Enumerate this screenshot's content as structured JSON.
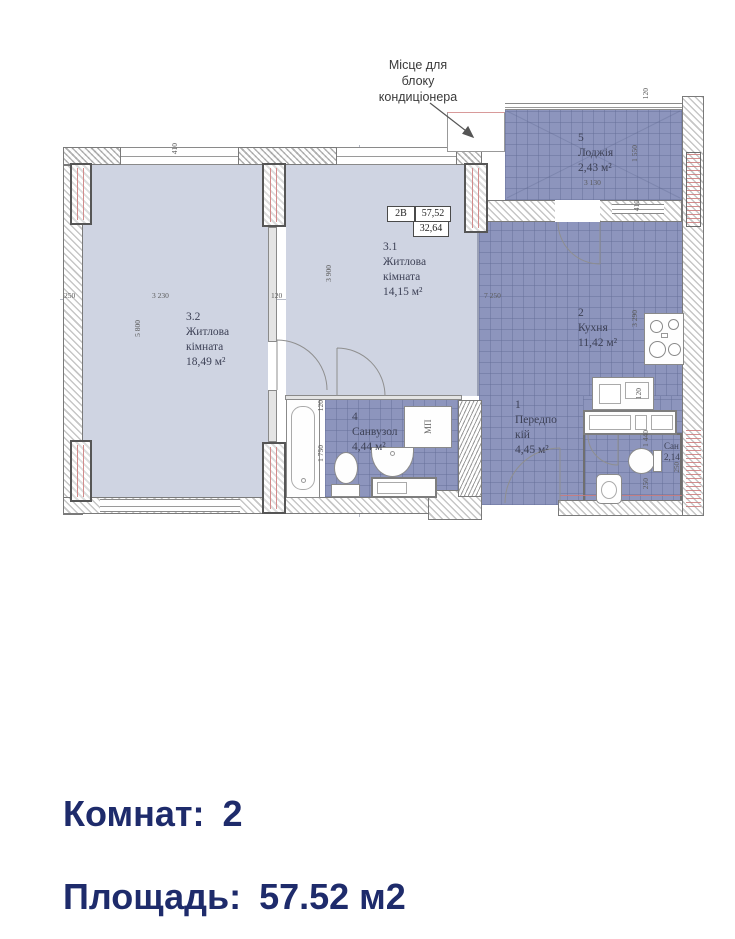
{
  "colors": {
    "room_light": "#cfd4e2",
    "room_dark_tile": "#8d95bd",
    "summary_navy": "#1e2b6b",
    "red_axis": "#d28b8b"
  },
  "ac_note": {
    "line1": "Місце для",
    "line2": "блоку",
    "line3": "кондиціонера"
  },
  "info_table": {
    "type": "2В",
    "total": "57,52",
    "living": "32,64"
  },
  "rooms": {
    "r32": {
      "num": "3.2",
      "name1": "Житлова",
      "name2": "кімната",
      "area": "18,49 м²"
    },
    "r31": {
      "num": "3.1",
      "name1": "Житлова",
      "name2": "кімната",
      "area": "14,15 м²"
    },
    "r5": {
      "num": "5",
      "name1": "Лоджія",
      "area": "2,43 м²"
    },
    "r2": {
      "num": "2",
      "name1": "Кухня",
      "area": "11,42 м²"
    },
    "r4": {
      "num": "4",
      "name1": "Санвузол",
      "area": "4,44 м²"
    },
    "r1": {
      "num": "1",
      "name1": "Передпо",
      "name2": "кій",
      "area": "4,45 м²"
    },
    "r3": {
      "name1": "Сан",
      "area": "2,14"
    }
  },
  "fixtures": {
    "washer_label": "МП"
  },
  "dims": {
    "w410a": "410",
    "w410b": "410",
    "d120a": "120",
    "d120b": "120",
    "d120c": "120",
    "d120d": "120",
    "d1550": "1 550",
    "d3130": "3 130",
    "d250a": "250",
    "d3230": "3 230",
    "d7250": "7 250",
    "d5800": "5 800",
    "d3900": "3 900",
    "d3290": "3 290",
    "d1750": "1 750",
    "d1440": "1 440",
    "d250b": "250",
    "d250c": "250"
  },
  "summary": {
    "rooms_label": "Комнат:",
    "rooms_value": "2",
    "area_label": "Площадь:",
    "area_value": "57.52 м2"
  }
}
